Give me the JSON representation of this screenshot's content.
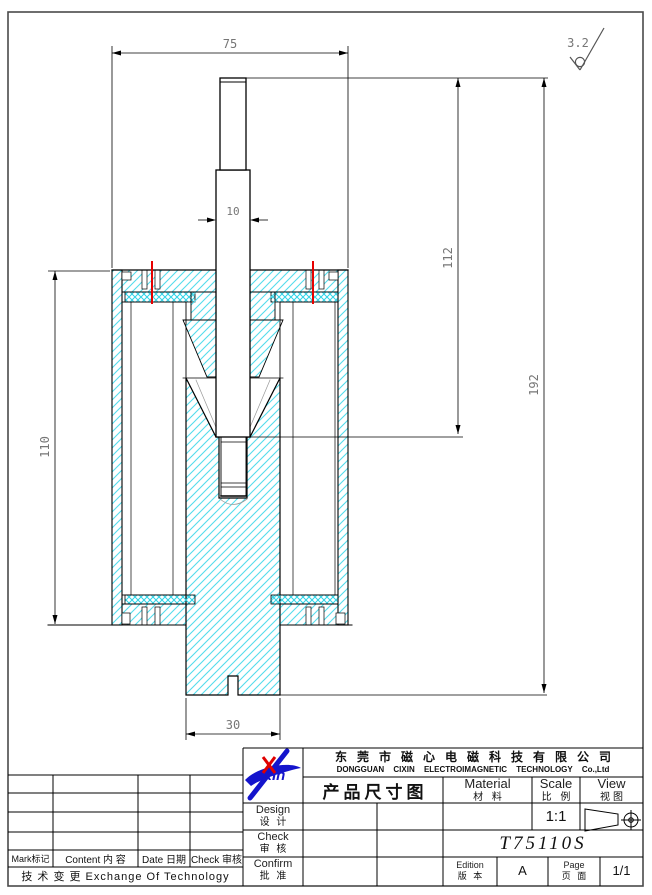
{
  "sheet": {
    "bg": "#ffffff",
    "border_color": "#4a4a4a"
  },
  "drawing": {
    "dims": {
      "overall_width": "75",
      "rod_width": "10",
      "stroke_height": "112",
      "total_height": "192",
      "body_height": "110",
      "core_width": "30"
    },
    "surface_roughness": "3.2",
    "colors": {
      "hatch": "#54dcec",
      "crosshatch": "#2ed2e6",
      "marker_red": "#e60000",
      "dim_text": "#767676",
      "outline": "#000000"
    }
  },
  "revision_table": {
    "headers": [
      "Mark标记",
      "Content 内 容",
      "Date 日期",
      "Check 审核"
    ],
    "footer": "技 术 变 更   Exchange Of Technology"
  },
  "title_block": {
    "company_cn": "东莞市磁心电磁科技有限公司",
    "company_en": "DONGGUAN CIXIN ELECTROIMAGNETIC TECHNOLOGY Co.,Ltd",
    "doc_title": "产品尺寸图",
    "material_en": "Material",
    "material_cn": "材 料",
    "scale_en": "Scale",
    "scale_cn": "比 例",
    "view_en": "View",
    "view_cn": "视图",
    "design_en": "Design",
    "design_cn": "设 计",
    "check_en": "Check",
    "check_cn": "审 核",
    "confirm_en": "Confirm",
    "confirm_cn": "批 准",
    "scale_value": "1:1",
    "part_number": "T75110S",
    "edition_en": "Edition",
    "edition_cn": "版 本",
    "edition_value": "A",
    "page_en": "Page",
    "page_cn": "页 面",
    "page_value": "1/1",
    "logo_text": "XIn"
  }
}
